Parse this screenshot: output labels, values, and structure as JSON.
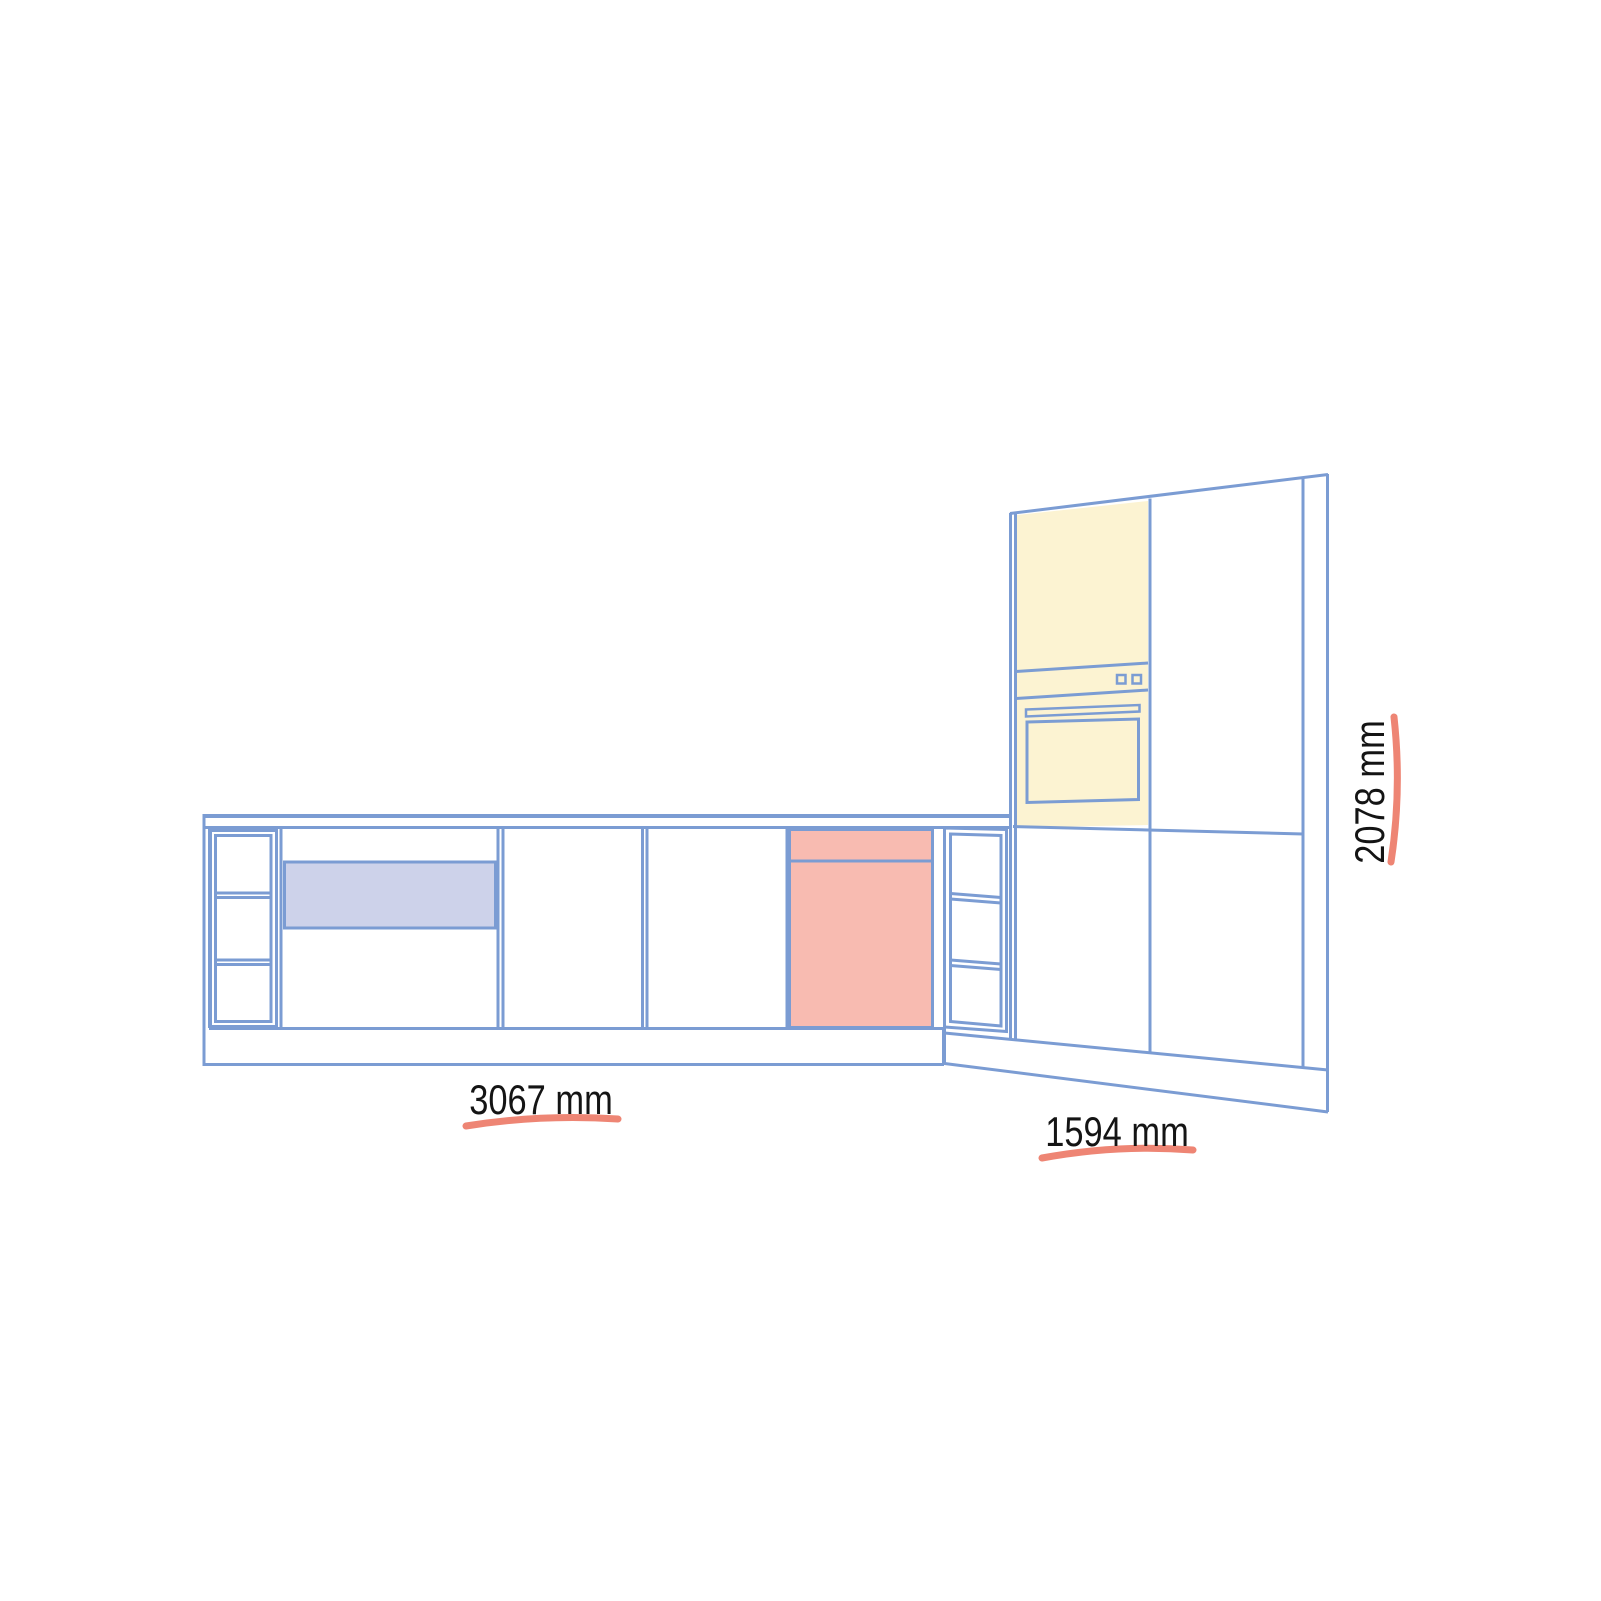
{
  "page": {
    "background": "#FFFFFF",
    "description": "Kitchen cabinet elevation drawing with dimension annotations"
  },
  "colors": {
    "line_blue": "#7B9CD3",
    "highlight_yellow": "#FCF3D2",
    "highlight_red": "#F8BBB1",
    "highlight_lavender": "#CDD2EA",
    "annotation_salmon": "#EE8574",
    "label_text": "#141414"
  },
  "annotations": {
    "base_run_width": {
      "value": 3067,
      "unit": "mm",
      "label": "3067 mm"
    },
    "right_run_width": {
      "value": 1594,
      "unit": "mm",
      "label": "1594 mm"
    },
    "tall_unit_height": {
      "value": 2078,
      "unit": "mm",
      "label": "2078 mm"
    }
  }
}
